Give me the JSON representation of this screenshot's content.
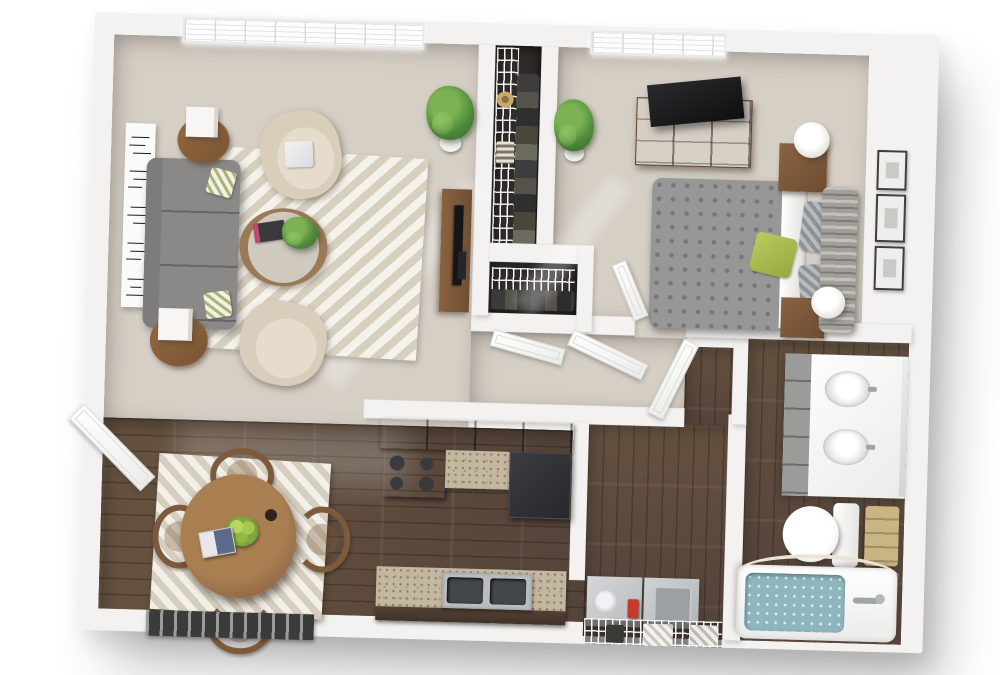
{
  "scene": {
    "type": "3d-floor-plan-render",
    "view": "top-down isometric",
    "unit": "one-bedroom one-bath apartment",
    "text_labels": "none visible"
  },
  "palette": {
    "background": "#ffffff",
    "walls": "#f3f2f0",
    "wall_shadow": "#cfcecb",
    "carpet": "#d6cfc6",
    "hardwood": "#5e4b3e",
    "area_rug_cream": "#e8e1d3",
    "sofa_gray": "#8b8987",
    "armchair_beige": "#d9cdbb",
    "wood_furniture": "#8a6242",
    "kitchen_cabinets": "#4b3b30",
    "granite_counter": "#c4b79f",
    "appliance_black": "#1d1d1f",
    "laundry_gray": "#cbcdcf",
    "detergent_red": "#c63a2c",
    "tub_water_teal": "#8fb6bd",
    "towel_tan": "#c9b483",
    "accent_green_pillow": "#a9bf55",
    "plant_green": "#4e8a3c",
    "closet_interior": "#2e2b28"
  },
  "rooms": [
    {
      "name": "Living Room",
      "floor": "carpet",
      "items": [
        "gray three-seat sofa with two patterned pillows",
        "two beige armchairs",
        "round glass coffee table with plant and book",
        "two round wood end tables with white cube lamps",
        "cream chevron area rug",
        "wood TV console with flat-screen TV",
        "tall black-and-white wall art panel",
        "potted floor plant",
        "picture window with blinds"
      ]
    },
    {
      "name": "Dining Area",
      "floor": "hardwood",
      "items": [
        "round wood dining table",
        "four curved-back dining chairs",
        "bowl of green apples",
        "book",
        "square cream area rug",
        "open entry door",
        "striped doormat"
      ]
    },
    {
      "name": "Kitchen",
      "floor": "hardwood",
      "items": [
        "dark wood cabinets",
        "granite countertops",
        "black four-burner range",
        "dark refrigerator",
        "double stainless-steel sink"
      ]
    },
    {
      "name": "Hallway",
      "floor": "carpet",
      "items": [
        "two open white closet-door leaves",
        "open bathroom door leaf"
      ]
    },
    {
      "name": "Walk-in Closet",
      "floor": "dark",
      "items": [
        "white wire shelving",
        "hanging clothes",
        "sun hat",
        "lower linen closet with wire shelf"
      ]
    },
    {
      "name": "Bedroom",
      "floor": "carpet",
      "items": [
        "bed with gray damask duvet",
        "white sheets and pillows",
        "green accent pillow",
        "gray tufted headboard",
        "two wood nightstands",
        "two white drum lamps",
        "wood dresser with flat-screen TV",
        "three framed pictures on wall",
        "potted floor plant",
        "picture window with blinds",
        "open bedroom door leaf"
      ]
    },
    {
      "name": "Bathroom",
      "floor": "hardwood",
      "items": [
        "white double-sink vanity with gray drawers and mirror",
        "toilet",
        "stack of tan towels",
        "bathtub with teal water",
        "shower curtain rod"
      ]
    },
    {
      "name": "Laundry Closet",
      "floor": "gray",
      "items": [
        "top-load washer",
        "dryer",
        "red detergent bottle",
        "wire shelf with hanging towels"
      ]
    }
  ]
}
